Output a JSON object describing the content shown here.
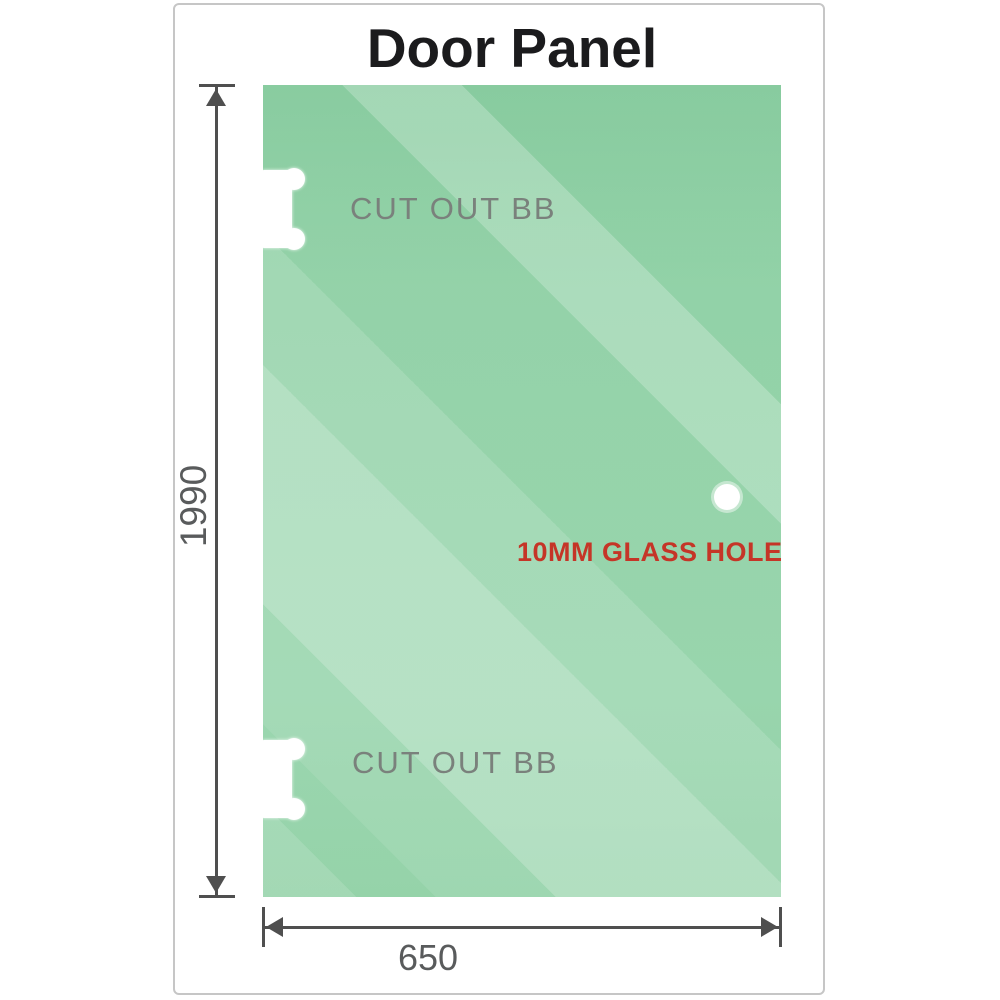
{
  "title": "Door Panel",
  "panel": {
    "cutouts": [
      {
        "label": "CUT OUT BB"
      },
      {
        "label": "CUT OUT BB"
      }
    ],
    "glass_hole": {
      "label": "10MM GLASS HOLE"
    }
  },
  "dimensions": {
    "height": "1990",
    "width": "650"
  },
  "colors": {
    "glass_green": "#8ed0a5",
    "glass_highlight": "#c3e7d0",
    "dimension_line": "#4f4f4f",
    "dimension_text": "#595b5c",
    "cutout_text": "#7a817c",
    "glass_hole_text": "#c53527",
    "title_text": "#1b1b1d",
    "card_border": "#c6c6c6"
  }
}
